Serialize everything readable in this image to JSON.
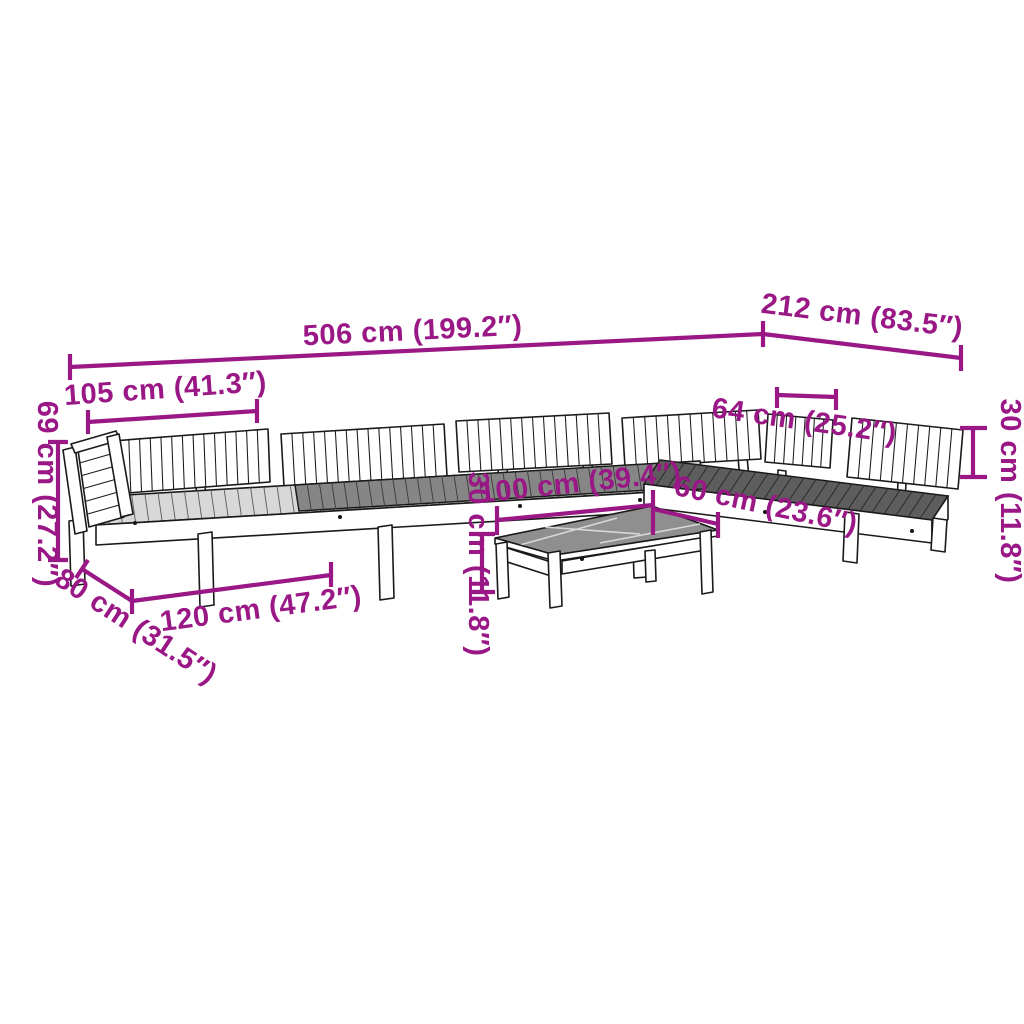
{
  "accent_color": "#9A1786",
  "line_color": "#1a1a1a",
  "background_color": "#ffffff",
  "shade_colors": {
    "seat_deck_light": "#d8d8d8",
    "seat_deck_mid": "#868686",
    "corner_deck_dark": "#5d5d5d",
    "table_top": "#8f8f8f"
  },
  "dimensions": {
    "total_length": {
      "label": "506 cm (199.2″)"
    },
    "right_wing_length": {
      "label": "212 cm (83.5″)"
    },
    "section_length": {
      "label": "105 cm (41.3″)"
    },
    "total_height": {
      "label": "69 cm (27.2″)"
    },
    "seat_depth": {
      "label": "80 cm (31.5″)"
    },
    "seat_section_length": {
      "label": "120 cm (47.2″)"
    },
    "table_length": {
      "label": "100 cm (39.4″)"
    },
    "table_depth": {
      "label": "60 cm (23.6″)"
    },
    "backrest_width": {
      "label": "64 cm (25.2″)"
    },
    "table_height": {
      "label": "30 cm (11.8″)"
    },
    "backrest_height": {
      "label": "30 cm (11.8″)"
    }
  }
}
